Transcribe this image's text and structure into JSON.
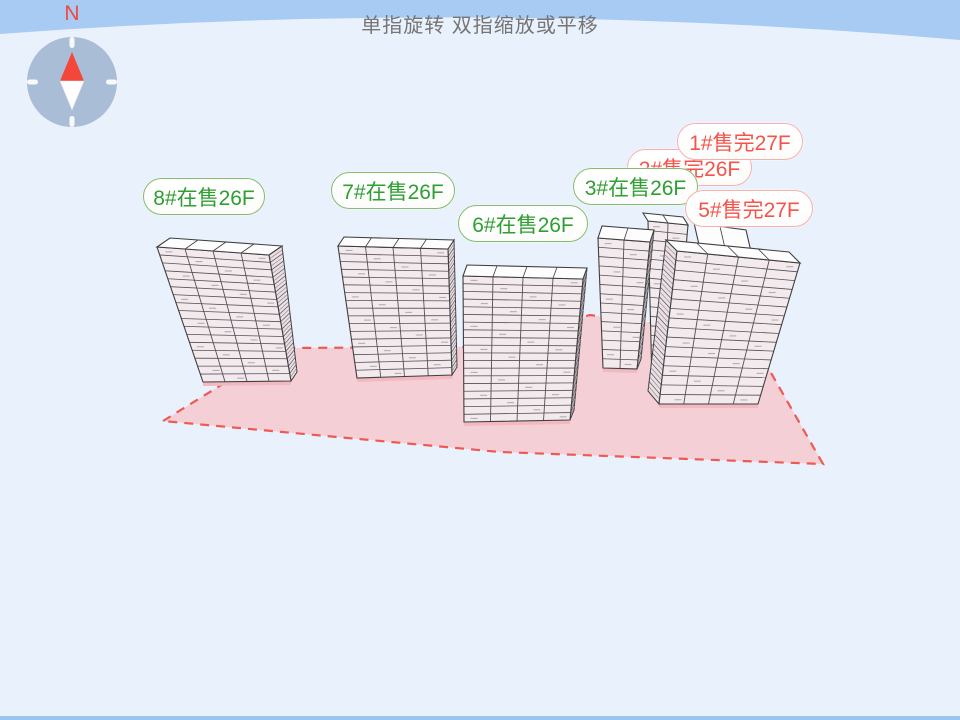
{
  "header": {
    "title": "单指旋转 双指缩放或平移",
    "compass_north_label": "N"
  },
  "buildings": [
    {
      "id": "8#",
      "label": "8#在售26F",
      "status": "selling"
    },
    {
      "id": "7#",
      "label": "7#在售26F",
      "status": "selling"
    },
    {
      "id": "6#",
      "label": "6#在售26F",
      "status": "selling"
    },
    {
      "id": "3#",
      "label": "3#在售26F",
      "status": "selling"
    },
    {
      "id": "2#",
      "label": "2#售完26F",
      "status": "sold_out"
    },
    {
      "id": "1#",
      "label": "1#售完27F",
      "status": "sold_out"
    },
    {
      "id": "5#",
      "label": "5#售完27F",
      "status": "sold_out"
    }
  ],
  "colors": {
    "selling_text": "#2f9e33",
    "selling_border": "#85bc6e",
    "sold_out_text": "#f5534b",
    "sold_out_border": "#f8b0ac",
    "site_fill": "#f4ccd2",
    "site_border": "#ee5a52",
    "sky_band": "#a7cbf2",
    "sky_bg": "#e9f1fc",
    "bottom_bar": "#9cc4ee",
    "compass_body": "#a9bdd7",
    "compass_needle": "#f4473a",
    "title_text": "#757575",
    "north_text": "#f5463d"
  }
}
